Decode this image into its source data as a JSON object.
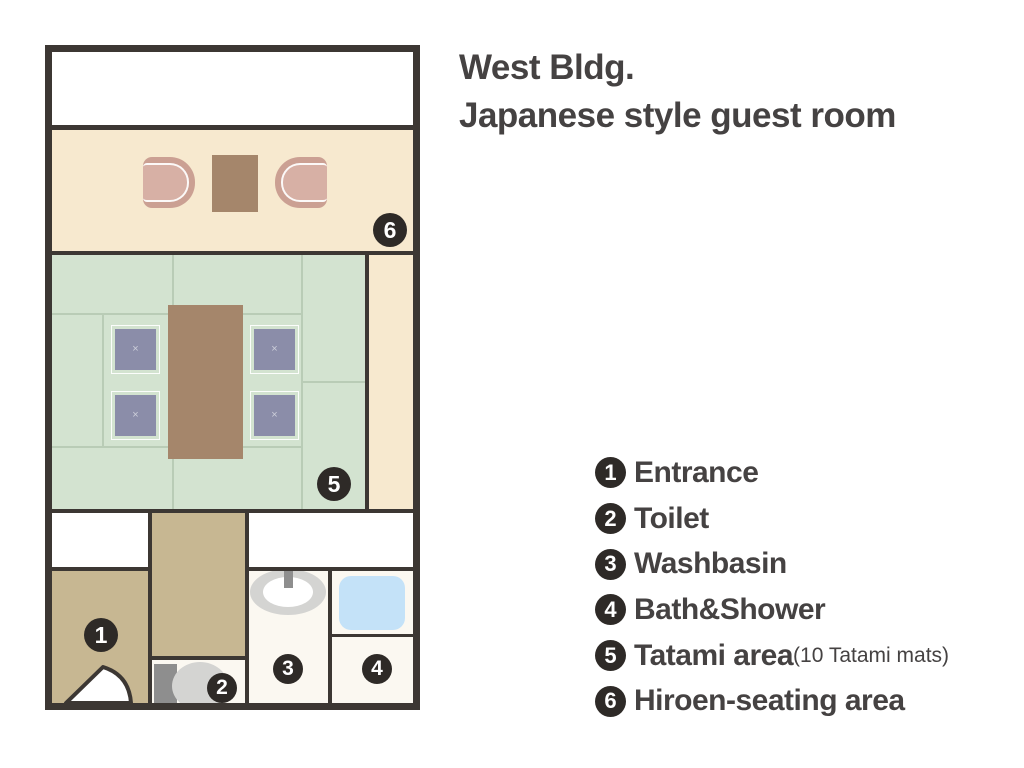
{
  "title": {
    "line1": "West Bldg.",
    "line2": "Japanese style guest room"
  },
  "legend": {
    "items": [
      {
        "num": "1",
        "label": "Entrance",
        "note": ""
      },
      {
        "num": "2",
        "label": "Toilet",
        "note": ""
      },
      {
        "num": "3",
        "label": "Washbasin",
        "note": ""
      },
      {
        "num": "4",
        "label": "Bath&Shower",
        "note": ""
      },
      {
        "num": "5",
        "label": "Tatami area",
        "note": "(10 Tatami mats)"
      },
      {
        "num": "6",
        "label": "Hiroen-seating area",
        "note": ""
      }
    ]
  },
  "floorplan": {
    "markers": [
      "1",
      "2",
      "3",
      "4",
      "5",
      "6"
    ],
    "cushion_mark": "×"
  },
  "palette": {
    "wall": "#3c3733",
    "cream": "#f7e9cf",
    "green": "#d3e3d0",
    "tatami_line": "#b9ccb6",
    "cushion": "#8b8da9",
    "table": "#a5866b",
    "chair": "#cba093",
    "chair_inner": "#d7b0a5",
    "tan": "#c7b792",
    "tub": "#c4e2f8",
    "badge": "#2e2a27",
    "text": "#454242",
    "fixture_gray": "#8e8e8e",
    "fixture_light": "#d4d4d2",
    "room_white": "#fbf8f1"
  }
}
